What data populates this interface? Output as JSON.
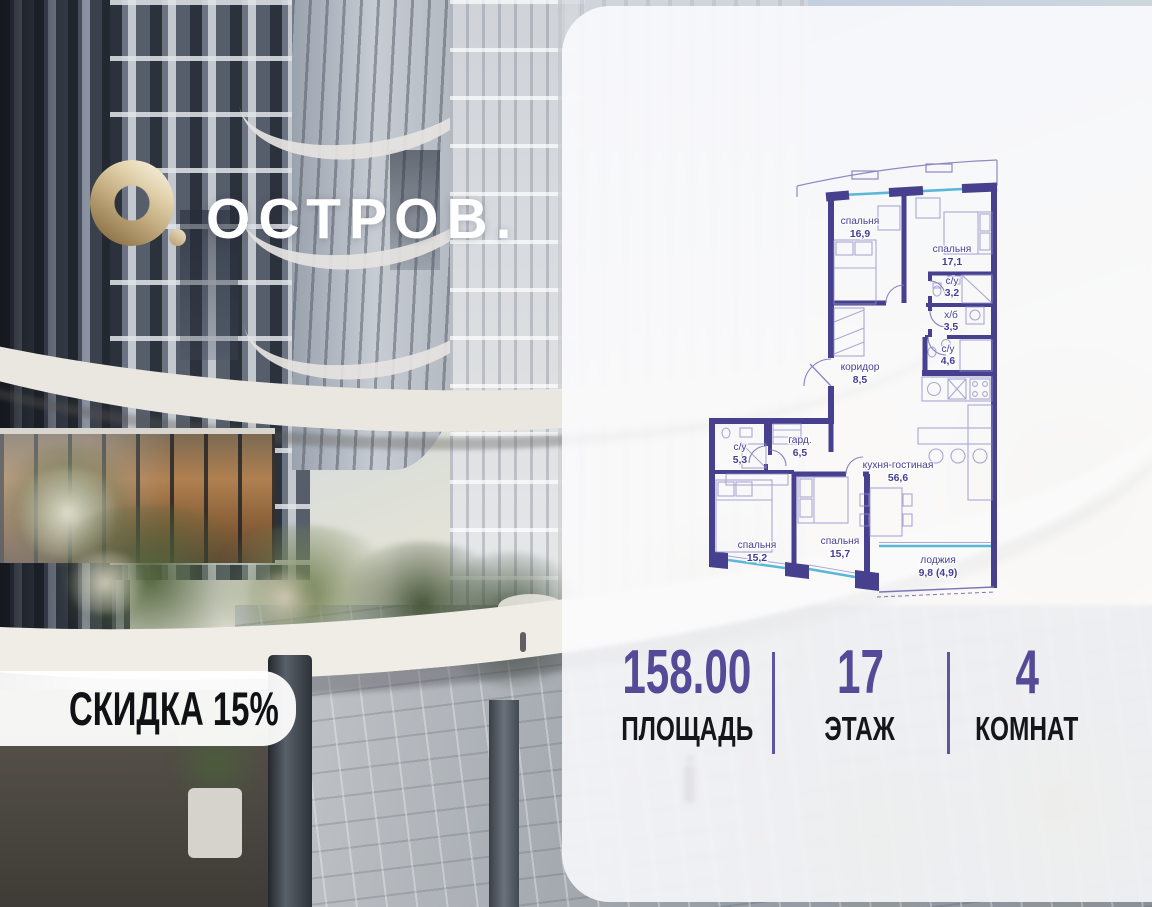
{
  "brand": {
    "name": "ОСТРОВ."
  },
  "badge": {
    "label": "СКИДКА 15%"
  },
  "stats": {
    "items": [
      {
        "value": "158.00",
        "label": "ПЛОЩАДЬ"
      },
      {
        "value": "17",
        "label": "ЭТАЖ"
      },
      {
        "value": "4",
        "label": "КОМНАТ"
      }
    ]
  },
  "floorplan": {
    "rooms": [
      {
        "name": "спальня",
        "area": "16,9"
      },
      {
        "name": "спальня",
        "area": "17,1"
      },
      {
        "name": "с/у",
        "area": "3,2"
      },
      {
        "name": "х/б",
        "area": "3,5"
      },
      {
        "name": "с/у",
        "area": "4,6"
      },
      {
        "name": "коридор",
        "area": "8,5"
      },
      {
        "name": "с/у",
        "area": "5,3"
      },
      {
        "name": "гард.",
        "area": "6,5"
      },
      {
        "name": "кухня-гостиная",
        "area": "56,6"
      },
      {
        "name": "спальня",
        "area": "15,2"
      },
      {
        "name": "спальня",
        "area": "15,7"
      },
      {
        "name": "лоджия",
        "area": "9,8 (4,9)"
      }
    ]
  },
  "colors": {
    "wall_accent": "#46408e",
    "glazing": "#5ab7d8",
    "stat_value": "#534b98",
    "logo_gold": "#c3ab7e",
    "badge_bg": "#ffffff"
  }
}
